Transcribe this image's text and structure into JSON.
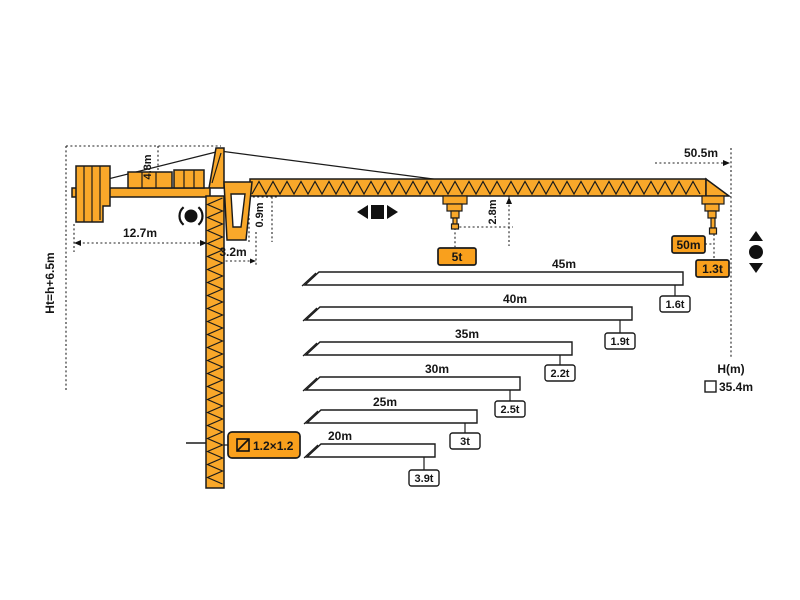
{
  "colors": {
    "crane_yellow": "#F9A82A",
    "label_orange": "#F9A01D",
    "outline": "#1b1b1b"
  },
  "dimensions": {
    "height_formula": "Ht=h+6.5m",
    "tower_head": "4.8m",
    "counter_jib": "12.7m",
    "tail_radius": "3.2m",
    "jib_section_height": "0.9m",
    "hook_to_jib": "2.8m",
    "max_radius": "50.5m"
  },
  "mid": {
    "capacity_label": "5t"
  },
  "tip": {
    "radius_label": "50m",
    "capacity_label": "1.3t"
  },
  "mast": {
    "section_label": "1.2×1.2"
  },
  "height_info": {
    "axis_label": "H(m)",
    "freestanding": "35.4m"
  },
  "icons": {
    "slewing": "rotation-circle-arrows",
    "trolley": "left-right-arrows-square",
    "hoist": "up-down-arrows-circle",
    "section": "square-with-diagonal",
    "height": "checkbox-square"
  },
  "load_chart": {
    "bars": [
      {
        "length": "45m",
        "capacity": "1.6t"
      },
      {
        "length": "40m",
        "capacity": "1.9t"
      },
      {
        "length": "35m",
        "capacity": "2.2t"
      },
      {
        "length": "30m",
        "capacity": "2.5t"
      },
      {
        "length": "25m",
        "capacity": "3t"
      },
      {
        "length": "20m",
        "capacity": "3.9t"
      }
    ]
  },
  "chart_data": {
    "type": "bar",
    "title": "Tower crane tip load vs jib length",
    "categories": [
      "50m",
      "45m",
      "40m",
      "35m",
      "30m",
      "25m",
      "20m"
    ],
    "values": [
      1.3,
      1.6,
      1.9,
      2.2,
      2.5,
      3.0,
      3.9
    ],
    "xlabel": "jib length (m)",
    "ylabel": "tip load (t)",
    "annotations": [
      "5t",
      "50.5m",
      "H(m)",
      "35.4m",
      "Ht=h+6.5m",
      "1.2×1.2"
    ]
  }
}
